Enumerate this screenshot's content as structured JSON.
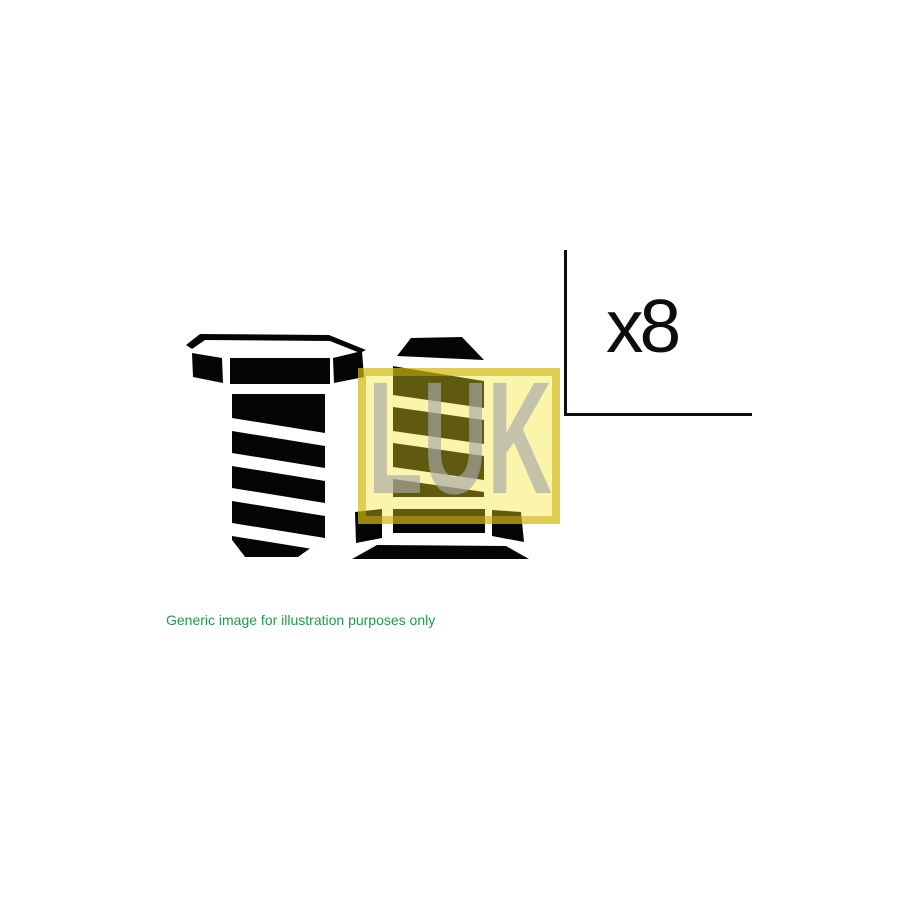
{
  "page": {
    "background_color": "#FFFFFF"
  },
  "product_image": {
    "illustration": {
      "left_bolt_icon": "hex-head-bolt-side-view-icon",
      "right_bolt_icon": "hex-head-bolt-underside-view-icon",
      "ink_color": "#050505"
    },
    "brand_logo": {
      "text": "LUK",
      "background_yellow": "#F9F5B1",
      "border_gold": "#D9C94A",
      "letters_gray": "#C6C6C6",
      "olive_overlay_on_black": "#57530C"
    },
    "quantity": {
      "label": "x8",
      "bracket_icon": "corner-bracket-line"
    },
    "disclaimer": {
      "text": "Generic image for illustration purposes only",
      "color": "#1E9B4E"
    }
  }
}
